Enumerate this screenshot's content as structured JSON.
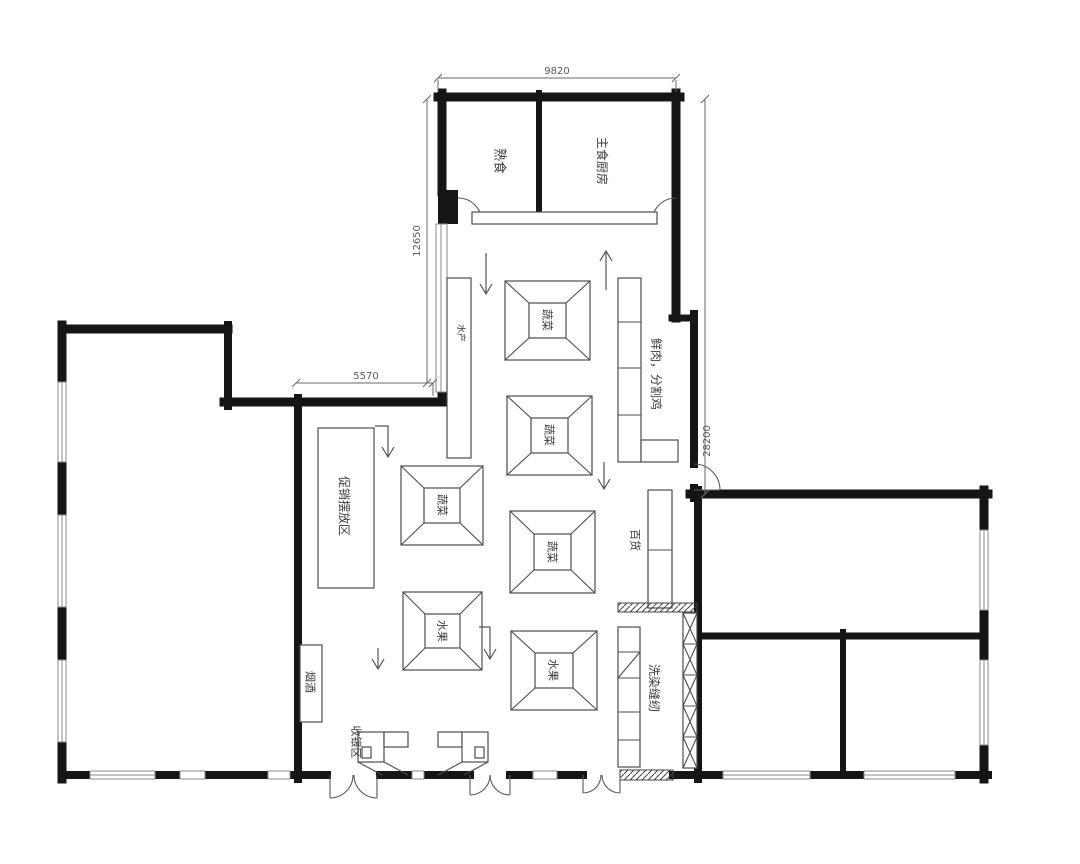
{
  "plan_title": "supermarket-floor-plan",
  "colors": {
    "wall": "#151515",
    "thin_line": "#4d4d4d",
    "dimension": "#6a6a6a",
    "label_text": "#3c3c3c",
    "background": "#ffffff"
  },
  "dims": {
    "top": "9820",
    "left": "12650",
    "inner": "5570",
    "right": "28200"
  },
  "labels": {
    "cooked_food": "熟食",
    "staple_kitchen": "主食厨房",
    "fresh_meat": "鲜肉，分割鸡",
    "aquatic": "水产",
    "general_goods": "百货",
    "promo_zone": "促销摆放区",
    "tobacco_alcohol": "烟酒",
    "cashier_zone": "收银区",
    "laundry_sewing": "洗染缝纫"
  },
  "tables": {
    "vegetable": "蔬菜",
    "fruit": "水果"
  }
}
